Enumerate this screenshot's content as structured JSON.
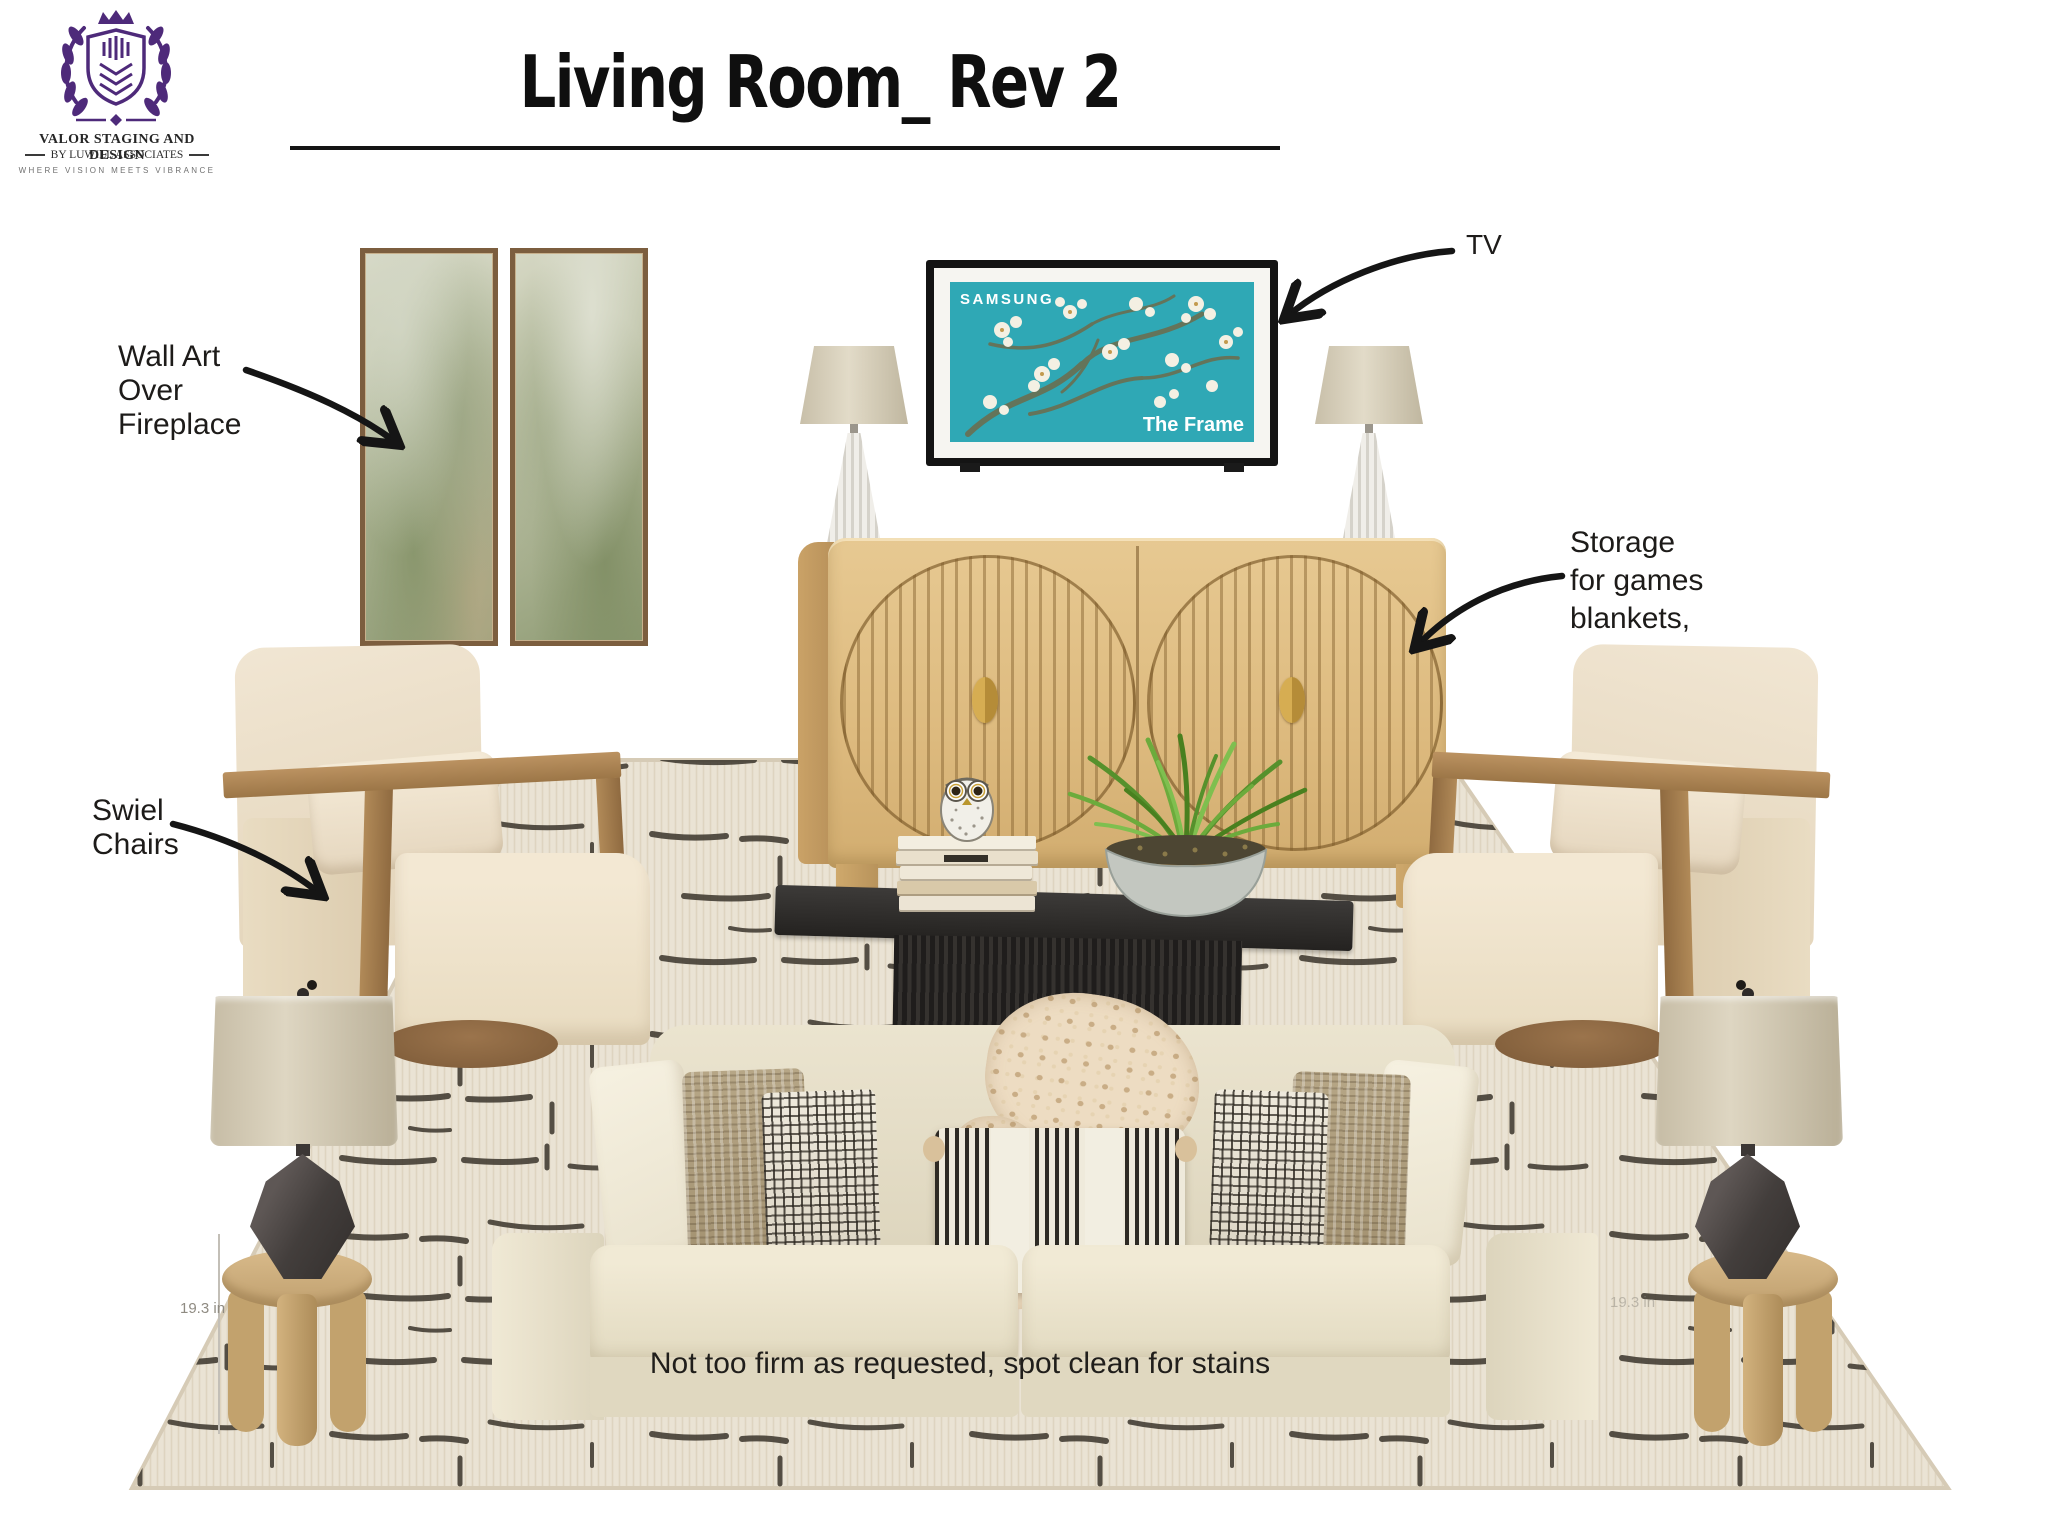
{
  "brand": {
    "logo_icon": "valor-crest",
    "name_line1": "VALOR STAGING AND DESIGN",
    "name_line2": "BY LUWILL ASSOCIATES",
    "tagline": "WHERE VISION MEETS VIBRANCE",
    "logo_color": "#4e2a7a"
  },
  "header": {
    "title": "Living Room_ Rev 2"
  },
  "tv": {
    "brand": "SAMSUNG",
    "model_label": "The Frame",
    "screen_color": "#2fa8b5"
  },
  "annotations": {
    "wall_art": {
      "lines": [
        "Wall Art",
        "Over",
        "Fireplace"
      ]
    },
    "tv_label": "TV",
    "storage": {
      "lines": [
        "Storage",
        "for games",
        "blankets,"
      ]
    },
    "swivel": {
      "lines": [
        "Swiel",
        "Chairs"
      ]
    },
    "sofa_note": "Not too firm as requested, spot clean for stains",
    "side_table_dimension": "19.3 in"
  },
  "palette": {
    "brand_purple": "#4e2a7a",
    "tv_teal": "#2fa8b5",
    "oak": "#d9b97f",
    "cream_upholstery": "#e8e1cc",
    "charcoal": "#2a2724"
  }
}
